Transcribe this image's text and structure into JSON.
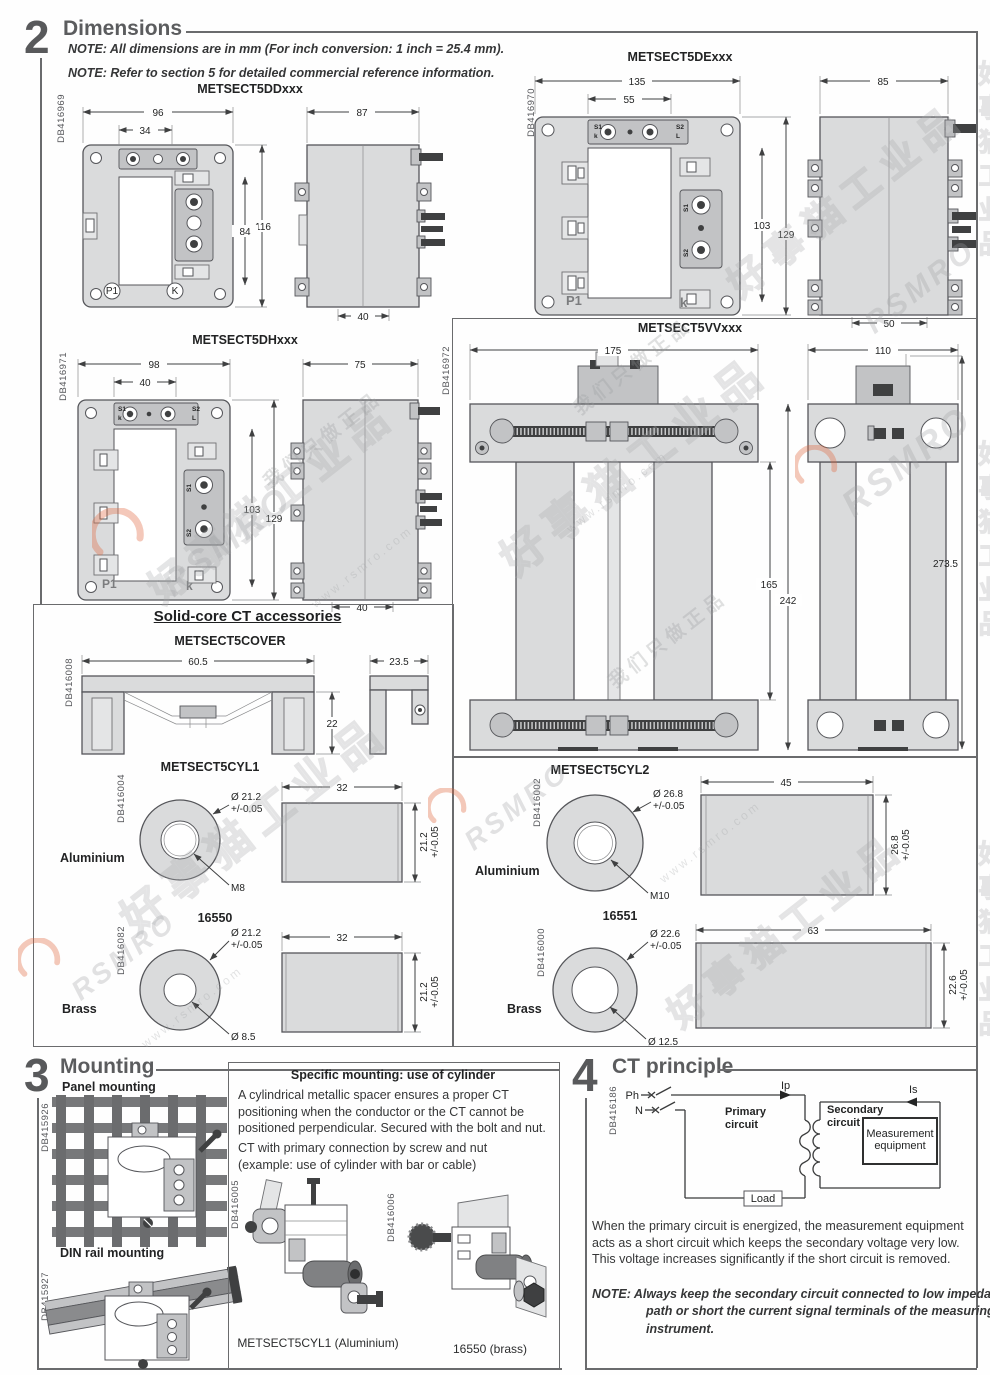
{
  "wm": {
    "brand": "RSMRO",
    "cn": "好事猫工业品",
    "cn2": "我们只做正品",
    "url": "www.rsmro.com"
  },
  "s2": {
    "num": "2",
    "title": "Dimensions",
    "note1": "NOTE: All dimensions are in mm (For inch conversion: 1 inch = 25.4 mm).",
    "note2": "NOTE: Refer to section 5 for detailed commercial reference information.",
    "dd": {
      "title": "METSECT5DDxxx",
      "ref": "DB416969",
      "w": "96",
      "ww": "34",
      "h": "116",
      "wh": "84",
      "sw": "87",
      "sd": "40",
      "p1": "P1",
      "k": "K"
    },
    "de": {
      "title": "METSECT5DExxx",
      "ref": "DB416970",
      "w": "135",
      "ww": "55",
      "h": "129",
      "wh": "103",
      "sw": "85",
      "sd": "50",
      "s1": "S1",
      "s1b": "k",
      "s2": "S2",
      "s2b": "L",
      "p1": "P1",
      "k": "k"
    },
    "dh": {
      "title": "METSECT5DHxxx",
      "ref": "DB416971",
      "w": "98",
      "ww": "40",
      "h": "129",
      "wh": "103",
      "sw": "75",
      "sd": "40",
      "s1": "S1",
      "s1b": "k",
      "s2": "S2",
      "s2b": "L",
      "p1": "P1",
      "k": "k"
    },
    "vv": {
      "title": "METSECT5VVxxx",
      "ref": "DB416972",
      "w": "175",
      "sw": "110",
      "h1": "165",
      "h2": "242",
      "sh": "273.5"
    }
  },
  "acc": {
    "title": "Solid-core CT accessories",
    "cover": {
      "title": "METSECT5COVER",
      "ref": "DB416008",
      "w": "60.5",
      "h": "22",
      "sw": "23.5"
    },
    "cyl1": {
      "title": "METSECT5CYL1",
      "ref": "DB416004",
      "mat": "Aluminium",
      "od": "Ø 21.2",
      "tol": "+/-0.05",
      "bore": "M8",
      "len": "32",
      "dia": "21.2",
      "dtol": "+/-0.05"
    },
    "b50": {
      "title": "16550",
      "ref": "DB416082",
      "mat": "Brass",
      "od": "Ø 21.2",
      "tol": "+/-0.05",
      "bore": "Ø 8.5",
      "len": "32",
      "dia": "21.2",
      "dtol": "+/-0.05"
    },
    "cyl2": {
      "title": "METSECT5CYL2",
      "ref": "DB416002",
      "mat": "Aluminium",
      "od": "Ø 26.8",
      "tol": "+/-0.05",
      "bore": "M10",
      "len": "45",
      "dia": "26.8",
      "dtol": "+/-0.05"
    },
    "b51": {
      "title": "16551",
      "ref": "DB416000",
      "mat": "Brass",
      "od": "Ø 22.6",
      "tol": "+/-0.05",
      "bore": "Ø 12.5",
      "len": "63",
      "dia": "22.6",
      "dtol": "+/-0.05"
    }
  },
  "s3": {
    "num": "3",
    "title": "Mounting",
    "panel_label": "Panel mounting",
    "panel_ref": "DB415926",
    "din_label": "DIN rail mounting",
    "din_ref": "DB415927",
    "spec_title": "Specific mounting: use of cylinder",
    "spec_p1": "A cylindrical metallic spacer ensures a proper CT positioning when the conductor or the CT cannot be positioned perpendicular. Secured with the bolt and nut.",
    "spec_p2a": "CT with primary connection by screw and nut",
    "spec_p2b": "(example: use of cylinder with bar or cable)",
    "fig1_ref": "DB416005",
    "fig1_caption": "METSECT5CYL1 (Aluminium)",
    "fig2_ref": "DB416006",
    "fig2_caption": "16550 (brass)"
  },
  "s4": {
    "num": "4",
    "title": "CT principle",
    "ref": "DB416186",
    "ph": "Ph",
    "n": "N",
    "ip": "Ip",
    "is": "Is",
    "primary": [
      "Primary",
      "circuit"
    ],
    "secondary": [
      "Secondary",
      "circuit"
    ],
    "meas": [
      "Measurement",
      "equipment"
    ],
    "load": "Load",
    "p1": "When the primary circuit is energized, the measurement equipment acts as a short circuit which keeps the secondary voltage very low. This voltage increases significantly if the short circuit is removed.",
    "note_label": "NOTE:",
    "note": "Always keep the secondary circuit connected to low impedance path or short the current signal terminals of the measuring instrument."
  }
}
